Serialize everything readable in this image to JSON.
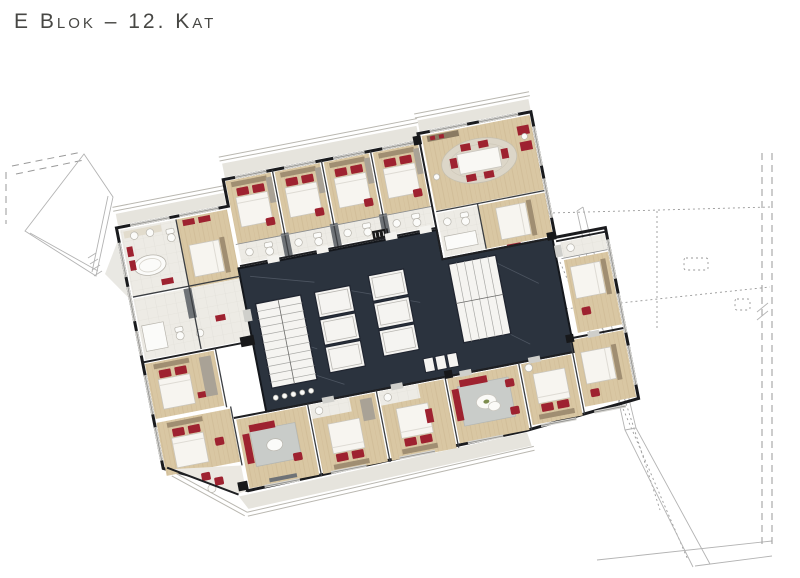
{
  "header": {
    "title": "E Blok – 12. Kat"
  },
  "plan": {
    "colors": {
      "corridor_floor": "#2b333e",
      "accent_furniture": "#9e2230",
      "wood_floor": "#d9c7a3",
      "exterior_wall": "#1a1b1e",
      "context_lines": "#b3b3b3",
      "balcony_deck": "#e6e4dd"
    }
  }
}
